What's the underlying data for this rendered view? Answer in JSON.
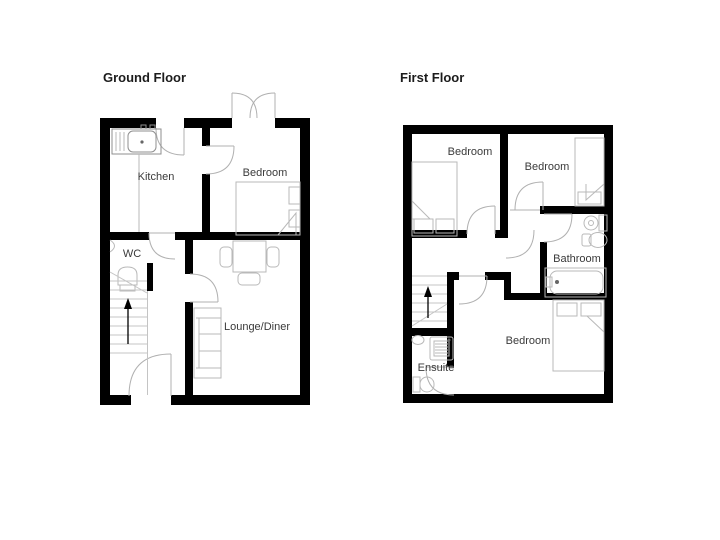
{
  "canvas": {
    "width": 720,
    "height": 540,
    "background": "#ffffff"
  },
  "colors": {
    "wall": "#000000",
    "fixture_line": "#b9b9b9",
    "door_arc": "#b0b0b0",
    "label_text": "#3a3a3a",
    "title_text": "#1c1c1c",
    "arrow": "#000000"
  },
  "floors": [
    {
      "title": "Ground Floor",
      "rooms": [
        {
          "label": "Kitchen"
        },
        {
          "label": "Bedroom"
        },
        {
          "label": "WC"
        },
        {
          "label": "Lounge/Diner"
        }
      ]
    },
    {
      "title": "First Floor",
      "rooms": [
        {
          "label": "Bedroom"
        },
        {
          "label": "Bedroom"
        },
        {
          "label": "Bathroom"
        },
        {
          "label": "Bedroom"
        },
        {
          "label": "Ensuite"
        }
      ]
    }
  ]
}
